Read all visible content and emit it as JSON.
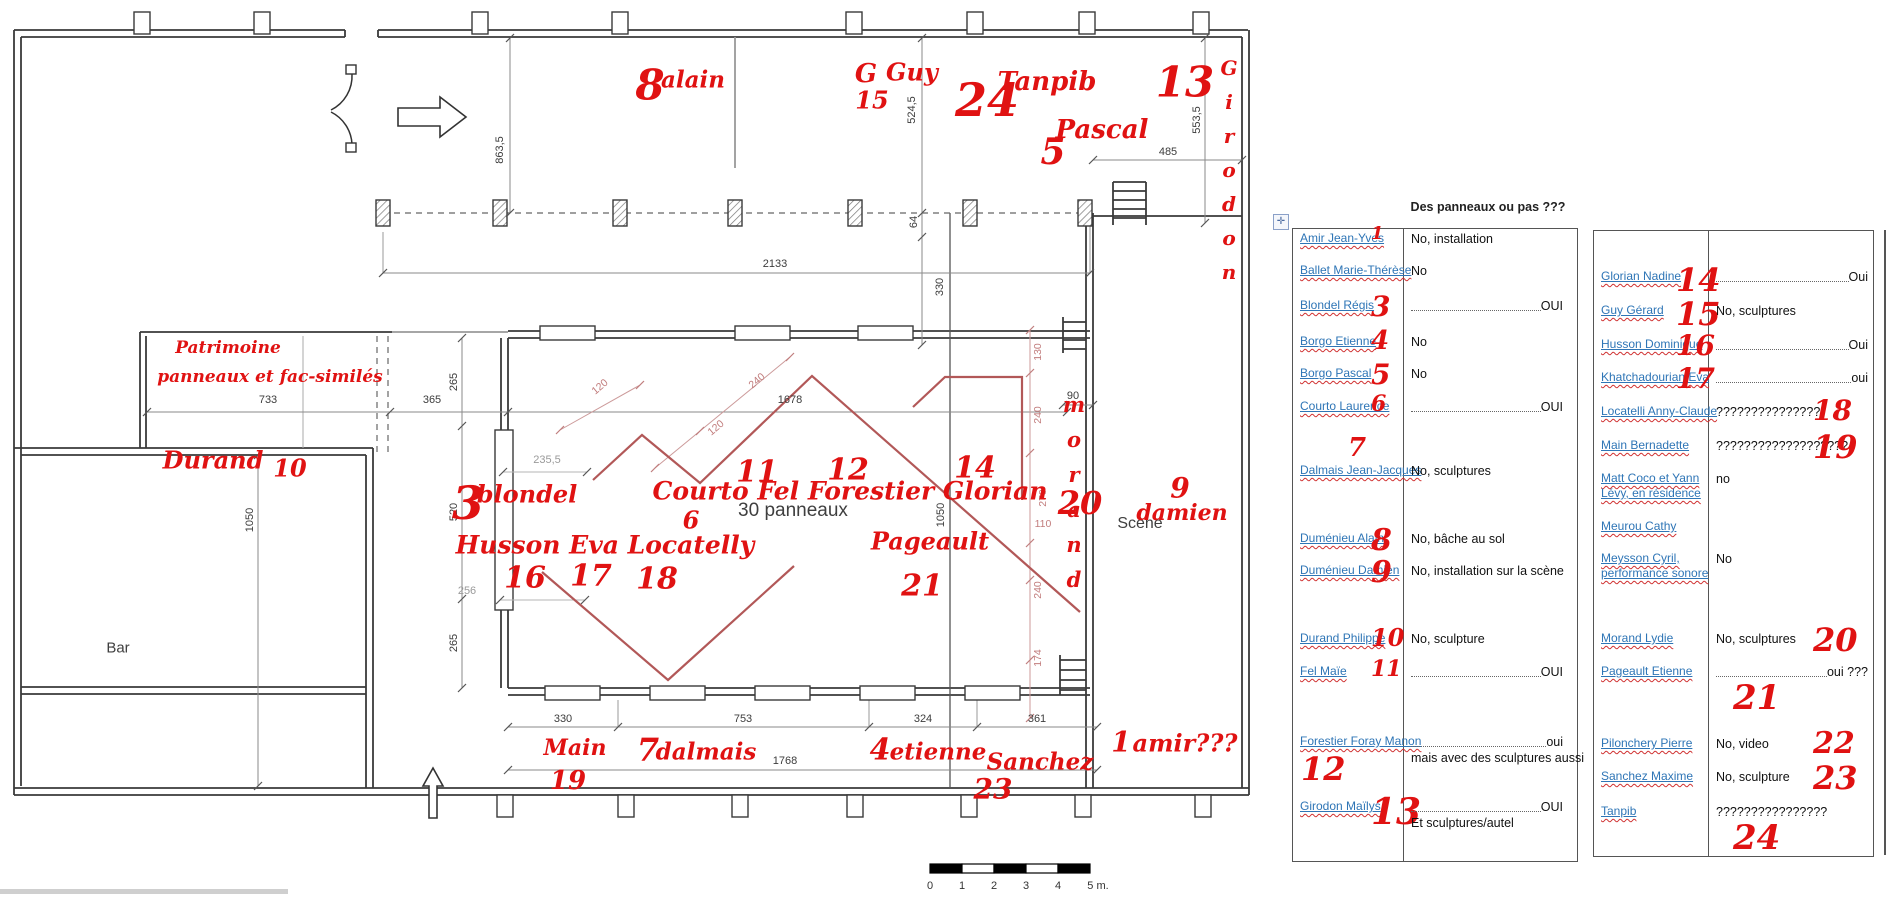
{
  "colors": {
    "ink_red": "#e01212",
    "link_blue": "#2e75b6",
    "panel_red": "#b25858"
  },
  "tables": {
    "title": "Des panneaux ou pas ???",
    "table1": {
      "rows": [
        {
          "name": "Amir Jean-Yves",
          "num": "1",
          "npos": "inline",
          "nsize": 18,
          "ans": "No, installation"
        },
        {
          "name": "Ballet Marie-Thérèse",
          "num": "",
          "ans": "No"
        },
        {
          "name": "Blondel Régis",
          "num": "3",
          "npos": "inline",
          "nsize": 28,
          "ans": "OUI",
          "leader": true
        },
        {
          "name": "Borgo Etienne",
          "num": "4",
          "npos": "inline",
          "nsize": 26,
          "ans": "No"
        },
        {
          "name": "Borgo Pascal",
          "num": "5",
          "npos": "inline",
          "nsize": 28,
          "ans": "No"
        },
        {
          "name": "Courto Laurence",
          "num": "6",
          "npos": "inline",
          "nsize": 22,
          "ans": "OUI",
          "leader": true
        },
        {
          "name": "Dalmais Jean-Jacques",
          "num": "7",
          "npos": "above",
          "nsize": 26,
          "ans": "No, sculptures"
        },
        {
          "name": "Duménieu Alain",
          "num": "8",
          "npos": "inline",
          "nsize": 30,
          "ans": "No, bâche au sol"
        },
        {
          "name": "Duménieu Damien",
          "num": "9",
          "npos": "inline",
          "nsize": 30,
          "ans": "No, installation sur la scène"
        },
        {
          "name": "Durand Philippe",
          "num": "10",
          "npos": "inline",
          "nsize": 24,
          "ans": "No, sculpture"
        },
        {
          "name": "Fel Maïe",
          "num": "11",
          "npos": "inline",
          "nsize": 22,
          "ans": "OUI",
          "leader": true
        },
        {
          "name": "Forestier Foray Manon",
          "num": "12",
          "npos": "below",
          "nsize": 32,
          "ans": "oui",
          "leader": true,
          "ans2": "mais avec des sculptures aussi"
        },
        {
          "name": "Girodon Maïlys",
          "num": "13",
          "npos": "inline",
          "nsize": 36,
          "ans": "OUI",
          "leader": true,
          "ans2": "Et sculptures/autel"
        }
      ]
    },
    "table2": {
      "rows": [
        {
          "name": "Glorian Nadine",
          "num": "14",
          "npos": "inline",
          "nsize": 32,
          "ans": "Oui",
          "leader": true
        },
        {
          "name": "Guy Gérard",
          "num": "15",
          "npos": "inline",
          "nsize": 32,
          "ans": "No, sculptures"
        },
        {
          "name": "Husson Dominique",
          "num": "16",
          "npos": "inline",
          "nsize": 28,
          "ans": "Oui",
          "leader": true
        },
        {
          "name": "Khatchadourian Eva",
          "num": "17",
          "npos": "inline",
          "nsize": 28,
          "ans": "oui",
          "leader": true
        },
        {
          "name": "Locatelli Anny-Claude",
          "num": "18",
          "npos": "ansafter",
          "nsize": 28,
          "ans": "???????????????"
        },
        {
          "name": "Main Bernadette",
          "num": "19",
          "npos": "ansafter",
          "nsize": 32,
          "ans": "???????????????????"
        },
        {
          "name": "Matt Coco et Yann\nLévy, en résidence",
          "num": "",
          "ans": "no"
        },
        {
          "name": "Meurou Cathy",
          "num": "",
          "ans": ""
        },
        {
          "name": "Meysson Cyril,\nperformance sonore",
          "num": "",
          "ans": "No"
        },
        {
          "name": "Morand Lydie",
          "num": "20",
          "npos": "ansafter",
          "nsize": 32,
          "ans": "No, sculptures"
        },
        {
          "name": "Pageault Etienne",
          "num": "21",
          "npos": "ansbelow",
          "nsize": 34,
          "ans": "oui ???",
          "leader": true
        },
        {
          "name": "Pilonchery Pierre",
          "num": "22",
          "npos": "ansafter",
          "nsize": 30,
          "ans": "No, video"
        },
        {
          "name": "Sanchez Maxime",
          "num": "23",
          "npos": "ansafter",
          "nsize": 32,
          "ans": "No, sculpture"
        },
        {
          "name": "Tanpib",
          "num": "24",
          "npos": "ansbelow",
          "nsize": 34,
          "ans": "????????????????"
        }
      ]
    }
  },
  "plan": {
    "texts": [
      {
        "t": "30 panneaux",
        "x": 793,
        "y": 511,
        "s": 19
      },
      {
        "t": "Scène",
        "x": 1140,
        "y": 524,
        "s": 16
      },
      {
        "t": "Bar",
        "x": 118,
        "y": 648,
        "s": 15
      }
    ],
    "dims_black": [
      {
        "t": "863,5",
        "x": 500,
        "y": 150,
        "rot": true
      },
      {
        "t": "2133",
        "x": 775,
        "y": 264
      },
      {
        "t": "524,5",
        "x": 912,
        "y": 110,
        "rot": true
      },
      {
        "t": "64",
        "x": 914,
        "y": 222,
        "rot": true
      },
      {
        "t": "330",
        "x": 940,
        "y": 287,
        "rot": true
      },
      {
        "t": "553,5",
        "x": 1197,
        "y": 120,
        "rot": true
      },
      {
        "t": "485",
        "x": 1168,
        "y": 152
      },
      {
        "t": "733",
        "x": 268,
        "y": 400
      },
      {
        "t": "365",
        "x": 432,
        "y": 400
      },
      {
        "t": "1678",
        "x": 790,
        "y": 400
      },
      {
        "t": "1050",
        "x": 250,
        "y": 520,
        "rot": true
      },
      {
        "t": "265",
        "x": 454,
        "y": 382,
        "rot": true
      },
      {
        "t": "520",
        "x": 454,
        "y": 512,
        "rot": true
      },
      {
        "t": "265",
        "x": 454,
        "y": 643,
        "rot": true
      },
      {
        "t": "90",
        "x": 1073,
        "y": 396
      },
      {
        "t": "1050",
        "x": 941,
        "y": 515,
        "rot": true
      },
      {
        "t": "330",
        "x": 563,
        "y": 719
      },
      {
        "t": "753",
        "x": 743,
        "y": 719
      },
      {
        "t": "324",
        "x": 923,
        "y": 719
      },
      {
        "t": "361",
        "x": 1037,
        "y": 719
      },
      {
        "t": "1768",
        "x": 785,
        "y": 761
      }
    ],
    "dims_gray": [
      {
        "t": "235,5",
        "x": 547,
        "y": 460
      },
      {
        "t": "256",
        "x": 467,
        "y": 591
      }
    ],
    "dims_red": [
      {
        "t": "120",
        "x": 600,
        "y": 387,
        "deg": -40
      },
      {
        "t": "120",
        "x": 716,
        "y": 428,
        "deg": -40
      },
      {
        "t": "240",
        "x": 757,
        "y": 381,
        "deg": -40
      },
      {
        "t": "130",
        "x": 1038,
        "y": 352,
        "rot": true
      },
      {
        "t": "240",
        "x": 1038,
        "y": 415,
        "rot": true
      },
      {
        "t": "270",
        "x": 1043,
        "y": 498,
        "rot": true
      },
      {
        "t": "110",
        "x": 1043,
        "y": 524
      },
      {
        "t": "240",
        "x": 1038,
        "y": 590,
        "rot": true
      },
      {
        "t": "174",
        "x": 1038,
        "y": 658,
        "rot": true
      }
    ],
    "red_names": [
      {
        "t": "alain",
        "x": 693,
        "y": 80,
        "s": 23
      },
      {
        "t": "G",
        "x": 866,
        "y": 74,
        "s": 26
      },
      {
        "t": "Guy",
        "x": 912,
        "y": 72,
        "s": 24
      },
      {
        "t": "Tanpib",
        "x": 1047,
        "y": 82,
        "s": 26
      },
      {
        "t": "Pascal",
        "x": 1102,
        "y": 130,
        "s": 26
      },
      {
        "t": "Girodon",
        "x": 1229,
        "y": 175,
        "s": 20,
        "v": true
      },
      {
        "t": "Patrimoine",
        "x": 228,
        "y": 348,
        "s": 17
      },
      {
        "t": "panneaux et fac-similés",
        "x": 270,
        "y": 377,
        "s": 17
      },
      {
        "t": "Durand",
        "x": 213,
        "y": 460,
        "s": 24
      },
      {
        "t": "blondel",
        "x": 527,
        "y": 494,
        "s": 24
      },
      {
        "t": "Courto Fel Forestier Glorian",
        "x": 850,
        "y": 491,
        "s": 25
      },
      {
        "t": "Husson Eva Locatelly",
        "x": 605,
        "y": 545,
        "s": 25
      },
      {
        "t": "Pageault",
        "x": 930,
        "y": 541,
        "s": 24
      },
      {
        "t": "morand",
        "x": 1074,
        "y": 497,
        "s": 21,
        "v": true
      },
      {
        "t": "damien",
        "x": 1182,
        "y": 513,
        "s": 22
      },
      {
        "t": "Main",
        "x": 575,
        "y": 748,
        "s": 22
      },
      {
        "t": "dalmais",
        "x": 706,
        "y": 752,
        "s": 23
      },
      {
        "t": "etienne",
        "x": 938,
        "y": 752,
        "s": 23
      },
      {
        "t": "Sanchez",
        "x": 1040,
        "y": 762,
        "s": 23
      },
      {
        "t": "amir???",
        "x": 1185,
        "y": 743,
        "s": 24
      }
    ],
    "red_numbers": [
      {
        "t": "8",
        "x": 650,
        "y": 85,
        "s": 42
      },
      {
        "t": "15",
        "x": 872,
        "y": 100,
        "s": 24
      },
      {
        "t": "24",
        "x": 987,
        "y": 100,
        "s": 46
      },
      {
        "t": "5",
        "x": 1053,
        "y": 152,
        "s": 36
      },
      {
        "t": "13",
        "x": 1185,
        "y": 82,
        "s": 42
      },
      {
        "t": "10",
        "x": 290,
        "y": 468,
        "s": 24
      },
      {
        "t": "3",
        "x": 468,
        "y": 503,
        "s": 46
      },
      {
        "t": "11",
        "x": 757,
        "y": 472,
        "s": 30
      },
      {
        "t": "12",
        "x": 848,
        "y": 470,
        "s": 30
      },
      {
        "t": "14",
        "x": 975,
        "y": 468,
        "s": 30
      },
      {
        "t": "6",
        "x": 691,
        "y": 520,
        "s": 24
      },
      {
        "t": "16",
        "x": 525,
        "y": 578,
        "s": 30
      },
      {
        "t": "17",
        "x": 591,
        "y": 576,
        "s": 30
      },
      {
        "t": "18",
        "x": 657,
        "y": 579,
        "s": 30
      },
      {
        "t": "21",
        "x": 922,
        "y": 586,
        "s": 30
      },
      {
        "t": "20",
        "x": 1080,
        "y": 503,
        "s": 32
      },
      {
        "t": "9",
        "x": 1180,
        "y": 488,
        "s": 28
      },
      {
        "t": "19",
        "x": 568,
        "y": 781,
        "s": 26
      },
      {
        "t": "7",
        "x": 648,
        "y": 750,
        "s": 32
      },
      {
        "t": "4",
        "x": 880,
        "y": 750,
        "s": 30
      },
      {
        "t": "23",
        "x": 993,
        "y": 789,
        "s": 28
      },
      {
        "t": "1",
        "x": 1121,
        "y": 742,
        "s": 28
      }
    ],
    "scale": {
      "labels": [
        "0",
        "1",
        "2",
        "3",
        "4",
        "5 m."
      ]
    }
  }
}
